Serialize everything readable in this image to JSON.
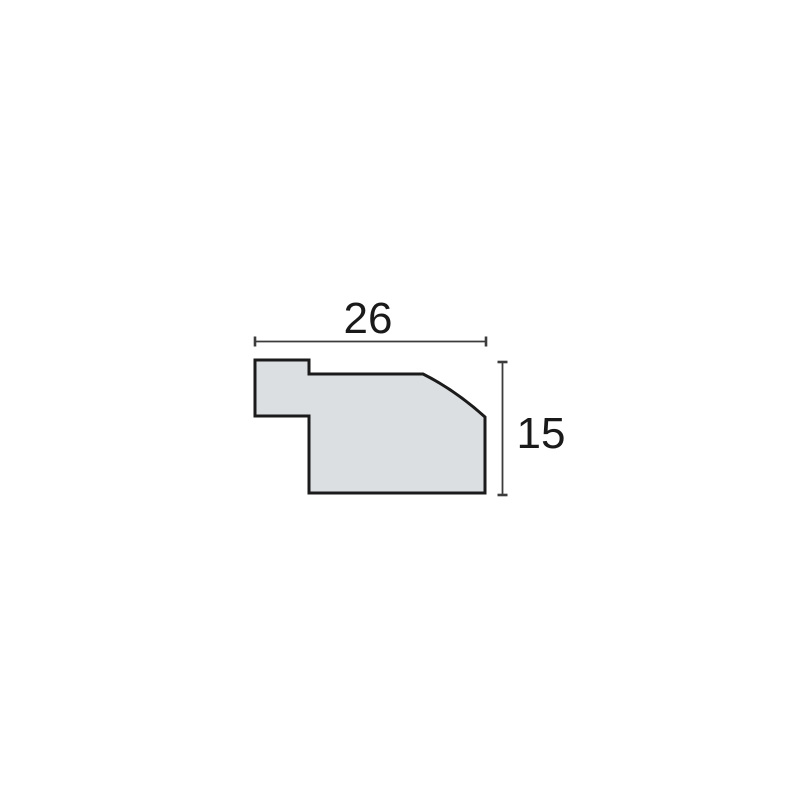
{
  "diagram": {
    "width_label": "26",
    "height_label": "15"
  },
  "colors": {
    "background": "#ffffff",
    "profile_fill": "#dcdfe1",
    "profile_stroke": "#1b1b1b",
    "dimension_line": "#3c3c3c",
    "label_color": "#1a1a1a"
  }
}
